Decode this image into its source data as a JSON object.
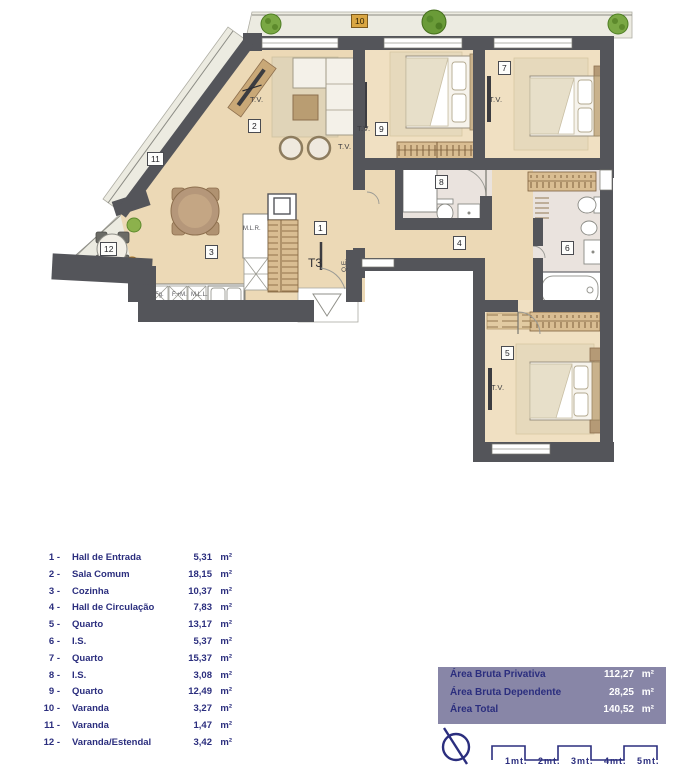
{
  "plan": {
    "unit_type_label": "T3",
    "room_numbers": [
      "1",
      "2",
      "3",
      "4",
      "5",
      "6",
      "7",
      "8",
      "9",
      "10",
      "11",
      "12"
    ],
    "tv_label": "T.V.",
    "kitchen_labels": {
      "washer": "M.L.R.",
      "fridge": "Fg.",
      "oven": "F.+M.",
      "dishwasher": "M.L.L."
    },
    "electrical_label": "Q.E."
  },
  "legend": {
    "items": [
      {
        "num": "1 -",
        "name": "Hall de Entrada",
        "value": "5,31",
        "unit": "m²"
      },
      {
        "num": "2 -",
        "name": "Sala Comum",
        "value": "18,15",
        "unit": "m²"
      },
      {
        "num": "3 -",
        "name": "Cozinha",
        "value": "10,37",
        "unit": "m²"
      },
      {
        "num": "4 -",
        "name": "Hall de Circulação",
        "value": "7,83",
        "unit": "m²"
      },
      {
        "num": "5 -",
        "name": "Quarto",
        "value": "13,17",
        "unit": "m²"
      },
      {
        "num": "6 -",
        "name": "I.S.",
        "value": "5,37",
        "unit": "m²"
      },
      {
        "num": "7 -",
        "name": "Quarto",
        "value": "15,37",
        "unit": "m²"
      },
      {
        "num": "8 -",
        "name": "I.S.",
        "value": "3,08",
        "unit": "m²"
      },
      {
        "num": "9 -",
        "name": "Quarto",
        "value": "12,49",
        "unit": "m²"
      },
      {
        "num": "10 -",
        "name": "Varanda",
        "value": "3,27",
        "unit": "m²"
      },
      {
        "num": "11 -",
        "name": "Varanda",
        "value": "1,47",
        "unit": "m²"
      },
      {
        "num": "12 -",
        "name": "Varanda/Estendal",
        "value": "3,42",
        "unit": "m²"
      }
    ]
  },
  "summary": {
    "rows": [
      {
        "label": "Área Bruta Privativa",
        "value": "112,27",
        "unit": "m²"
      },
      {
        "label": "Área Bruta Dependente",
        "value": "28,25",
        "unit": "m²"
      },
      {
        "label": "Área Total",
        "value": "140,52",
        "unit": "m²"
      }
    ]
  },
  "scale_bar": {
    "labels": [
      "1mt.",
      "2mt.",
      "3mt.",
      "4mt.",
      "5mt."
    ]
  }
}
